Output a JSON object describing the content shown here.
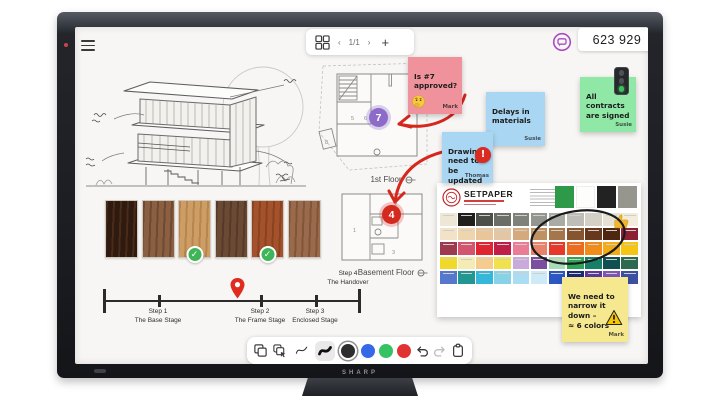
{
  "device": {
    "brand": "SHARP"
  },
  "topbar": {
    "menu_icon": "hamburger-icon",
    "pager": {
      "grid_icon": "pages-grid-icon",
      "prev": "‹",
      "page": "1/1",
      "next": "›",
      "add": "+"
    },
    "chat_icon": "chat-bubble-icon",
    "counter": "623 929"
  },
  "canvas": {
    "stickies": [
      {
        "text": "Is #7\napproved?",
        "author": "Mark",
        "color": "#f0929b",
        "icon": "thinking-emoji"
      },
      {
        "text": "Delays in\nmaterials",
        "author": "Susie",
        "color": "#a9d6f2",
        "icon": ""
      },
      {
        "text": "Drawings\nneed to be\nupdated",
        "author": "Thomas",
        "color": "#a9d6f2",
        "icon": "alert-icon"
      },
      {
        "text": "All\ncontracts\nare signed",
        "author": "Susie",
        "color": "#8fe8a5",
        "icon": "traffic-light-icon"
      },
      {
        "text": "We need to\nnarrow it\ndown –\n≈ 6 colors",
        "author": "Mark",
        "color": "#f5e88f",
        "icon": "warning-icon"
      }
    ],
    "floor_labels": {
      "first": "1st Floor",
      "basement": "Basement Floor"
    },
    "markers": {
      "purple": "7",
      "red": "4"
    },
    "rooms": {
      "upper": [
        "5",
        "6",
        "8"
      ],
      "lower": [
        "1",
        "2",
        "3"
      ]
    },
    "timeline": {
      "steps": [
        {
          "step": "Step 1",
          "label": "The Base Stage"
        },
        {
          "step": "Step 2",
          "label": "The Frame Stage"
        },
        {
          "step": "Step 3",
          "label": "Enclosed Stage"
        },
        {
          "step": "Step 4",
          "label": "The Handover"
        }
      ],
      "pin_icon": "location-pin-icon"
    },
    "palette": {
      "title": "SETPAPER",
      "header_swatches": [
        "#2e9948",
        "#fdfdfc",
        "#222222",
        "#97968e"
      ],
      "rows": [
        [
          "#efe7d6",
          "#201f1d",
          "#4d4f49",
          "#6b6d67",
          "#7f817b",
          "#93958f",
          "#a9aba5",
          "#bfbdb7",
          "#d4d0c6",
          "#e6e1d3",
          "#f2ecdd"
        ],
        [
          "#f2e3c8",
          "#efd5ad",
          "#eac59a",
          "#e3c7a5",
          "#d4aa7c",
          "#c09160",
          "#a5764b",
          "#855530",
          "#68381c",
          "#4f2710",
          "#8c2136"
        ],
        [
          "#9e3a50",
          "#d4566e",
          "#e02430",
          "#c01e46",
          "#ea7c96",
          "#e8836a",
          "#e6392a",
          "#ec6b1d",
          "#f08c1a",
          "#f4ab17",
          "#f6c415"
        ],
        [
          "#f1d928",
          "#f4ecb4",
          "#f6cb8e",
          "#f2e14e",
          "#c9aada",
          "#7c4f9e",
          "#a8dcb8",
          "#2fa457",
          "#157f68",
          "#114f52",
          "#2d6a4f"
        ],
        [
          "#5577cc",
          "#219693",
          "#35b7d9",
          "#88d2e8",
          "#aadcf2",
          "#cdeaf6",
          "#2b57c4",
          "#1b2a78",
          "#5a3a9c",
          "#7f56b8",
          "#3d4fa1"
        ]
      ],
      "annotation_icon": "thumbs-up-icon"
    },
    "wood": {
      "colors": [
        [
          "#2e1a0f",
          "#4a2a18"
        ],
        [
          "#8a5f42",
          "#6e4a30"
        ],
        [
          "#cd9d66",
          "#b9854e"
        ],
        [
          "#6b4a33",
          "#55392a"
        ],
        [
          "#a3522b",
          "#8a421f"
        ],
        [
          "#9a6a4c",
          "#835538"
        ]
      ],
      "approved": [
        2,
        4
      ],
      "check_icon": "approved-check-icon"
    }
  },
  "toolbar": {
    "tools": [
      "copy",
      "duplicate",
      "pen-thin",
      "pen-bold"
    ],
    "colors": [
      {
        "name": "black",
        "hex": "#2e2e2e",
        "selected": true
      },
      {
        "name": "blue",
        "hex": "#3569e7",
        "selected": false
      },
      {
        "name": "green",
        "hex": "#35c263",
        "selected": false
      },
      {
        "name": "red",
        "hex": "#e23333",
        "selected": false
      }
    ],
    "actions": [
      "undo",
      "redo",
      "clipboard"
    ]
  }
}
